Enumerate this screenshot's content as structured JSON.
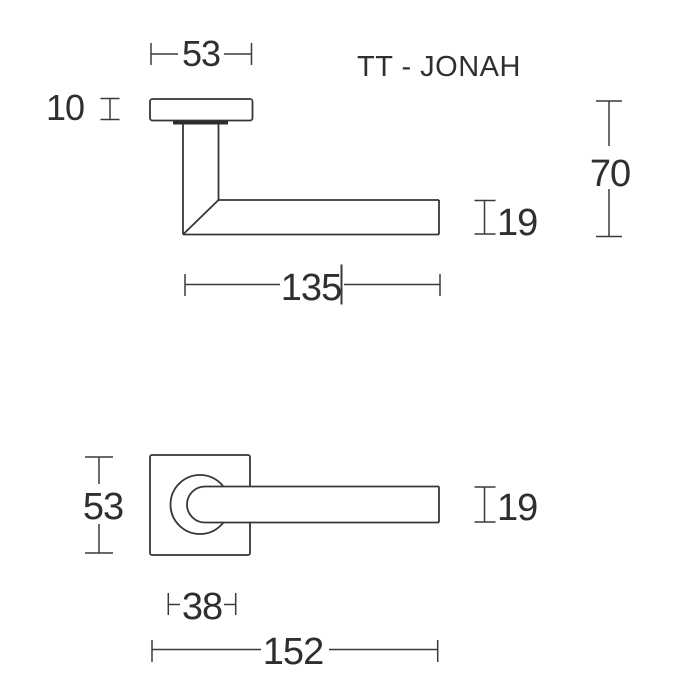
{
  "title": "TT - JONAH",
  "colors": {
    "line": "#363636",
    "dimension_line": "#3a3a3a",
    "text": "#2f2f2f",
    "background": "#ffffff"
  },
  "side_view": {
    "label": "side-profile-view",
    "dims": {
      "rose_diameter": "53",
      "rose_thickness": "10",
      "handle_projection": "70",
      "grip_section": "19",
      "grip_length": "135"
    }
  },
  "front_view": {
    "label": "front-face-view",
    "dims": {
      "rose_size": "53",
      "grip_section": "19",
      "rose_width": "38",
      "overall_length": "152"
    }
  }
}
